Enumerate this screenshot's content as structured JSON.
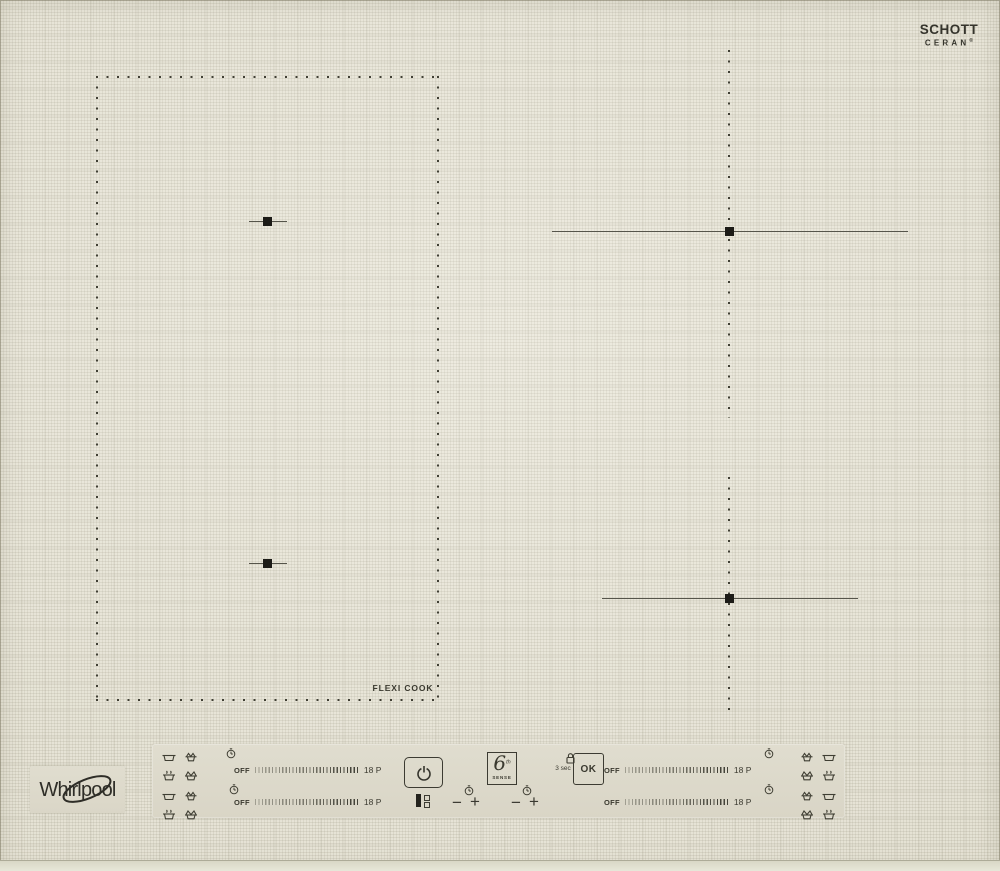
{
  "colors": {
    "glass": "#e9e6d8",
    "panel": "#ddd9cb",
    "ink": "#3a392f",
    "zone_marks": "#1c1b17"
  },
  "brand": {
    "name": "Whirlpool"
  },
  "glass_brand": {
    "line1": "SCHOTT",
    "line2": "CERAN",
    "registered": "®"
  },
  "zones": {
    "flexicook_label": "FLEXI COOK"
  },
  "panel": {
    "sliders": [
      {
        "id": "left-top",
        "off": "OFF",
        "max": "18 P"
      },
      {
        "id": "left-bottom",
        "off": "OFF",
        "max": "18 P"
      },
      {
        "id": "right-top",
        "off": "OFF",
        "max": "18 P"
      },
      {
        "id": "right-bottom",
        "off": "OFF",
        "max": "18 P"
      }
    ],
    "ok_label": "OK",
    "lock_hint": "3 sec",
    "minus": "−",
    "plus": "+",
    "sixth_sense": {
      "digit": "6",
      "sup": "th",
      "word": "sense"
    }
  },
  "icons": {
    "power": "power-icon",
    "lock": "lock-icon",
    "timer": "clock-icon",
    "flexicook_key": "flexizone-indicator-icon",
    "cookware": [
      "pan-icon",
      "boil-icon",
      "steam-pot-icon",
      "simmer-icon"
    ]
  }
}
